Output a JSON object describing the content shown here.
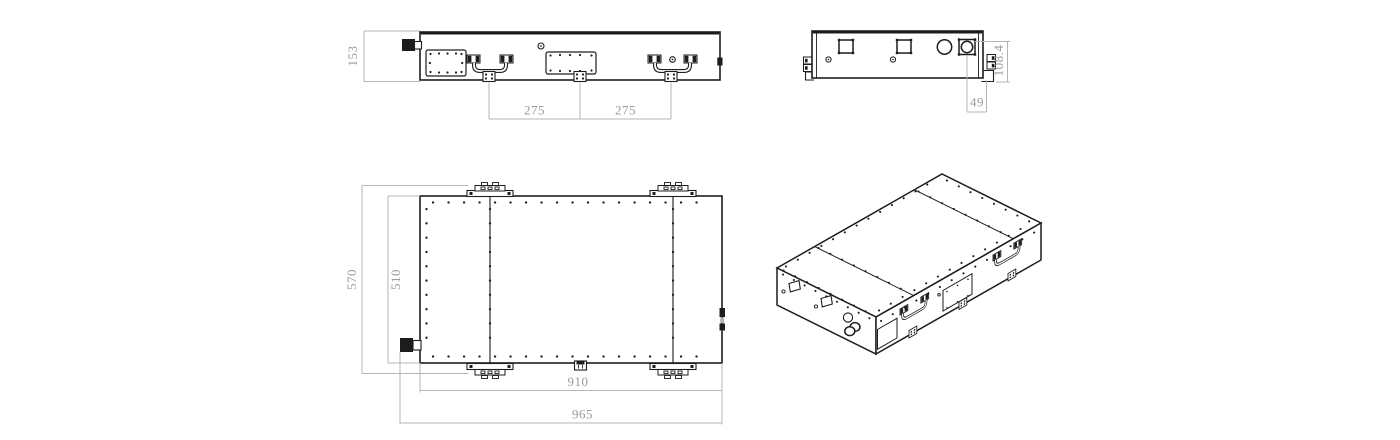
{
  "meta": {
    "type": "engineering-drawing",
    "subject": "rectangular enclosure with connectors, handles, access plates and mounting brackets"
  },
  "colors": {
    "bg": "#ffffff",
    "line": "#1d1d1d",
    "dim_line": "#b5b5b5",
    "dim_text": "#9a9a9a"
  },
  "views": {
    "front": {
      "label": "front elevation",
      "dims": {
        "height": "153",
        "span_left": "275",
        "span_right": "275"
      }
    },
    "side": {
      "label": "end elevation",
      "dims": {
        "height": "108.4",
        "offset": "49"
      }
    },
    "plan": {
      "label": "top plan",
      "dims": {
        "width_outer": "570",
        "width_inner": "510",
        "length_inner": "910",
        "length_outer": "965"
      }
    },
    "iso": {
      "label": "isometric projection"
    }
  }
}
